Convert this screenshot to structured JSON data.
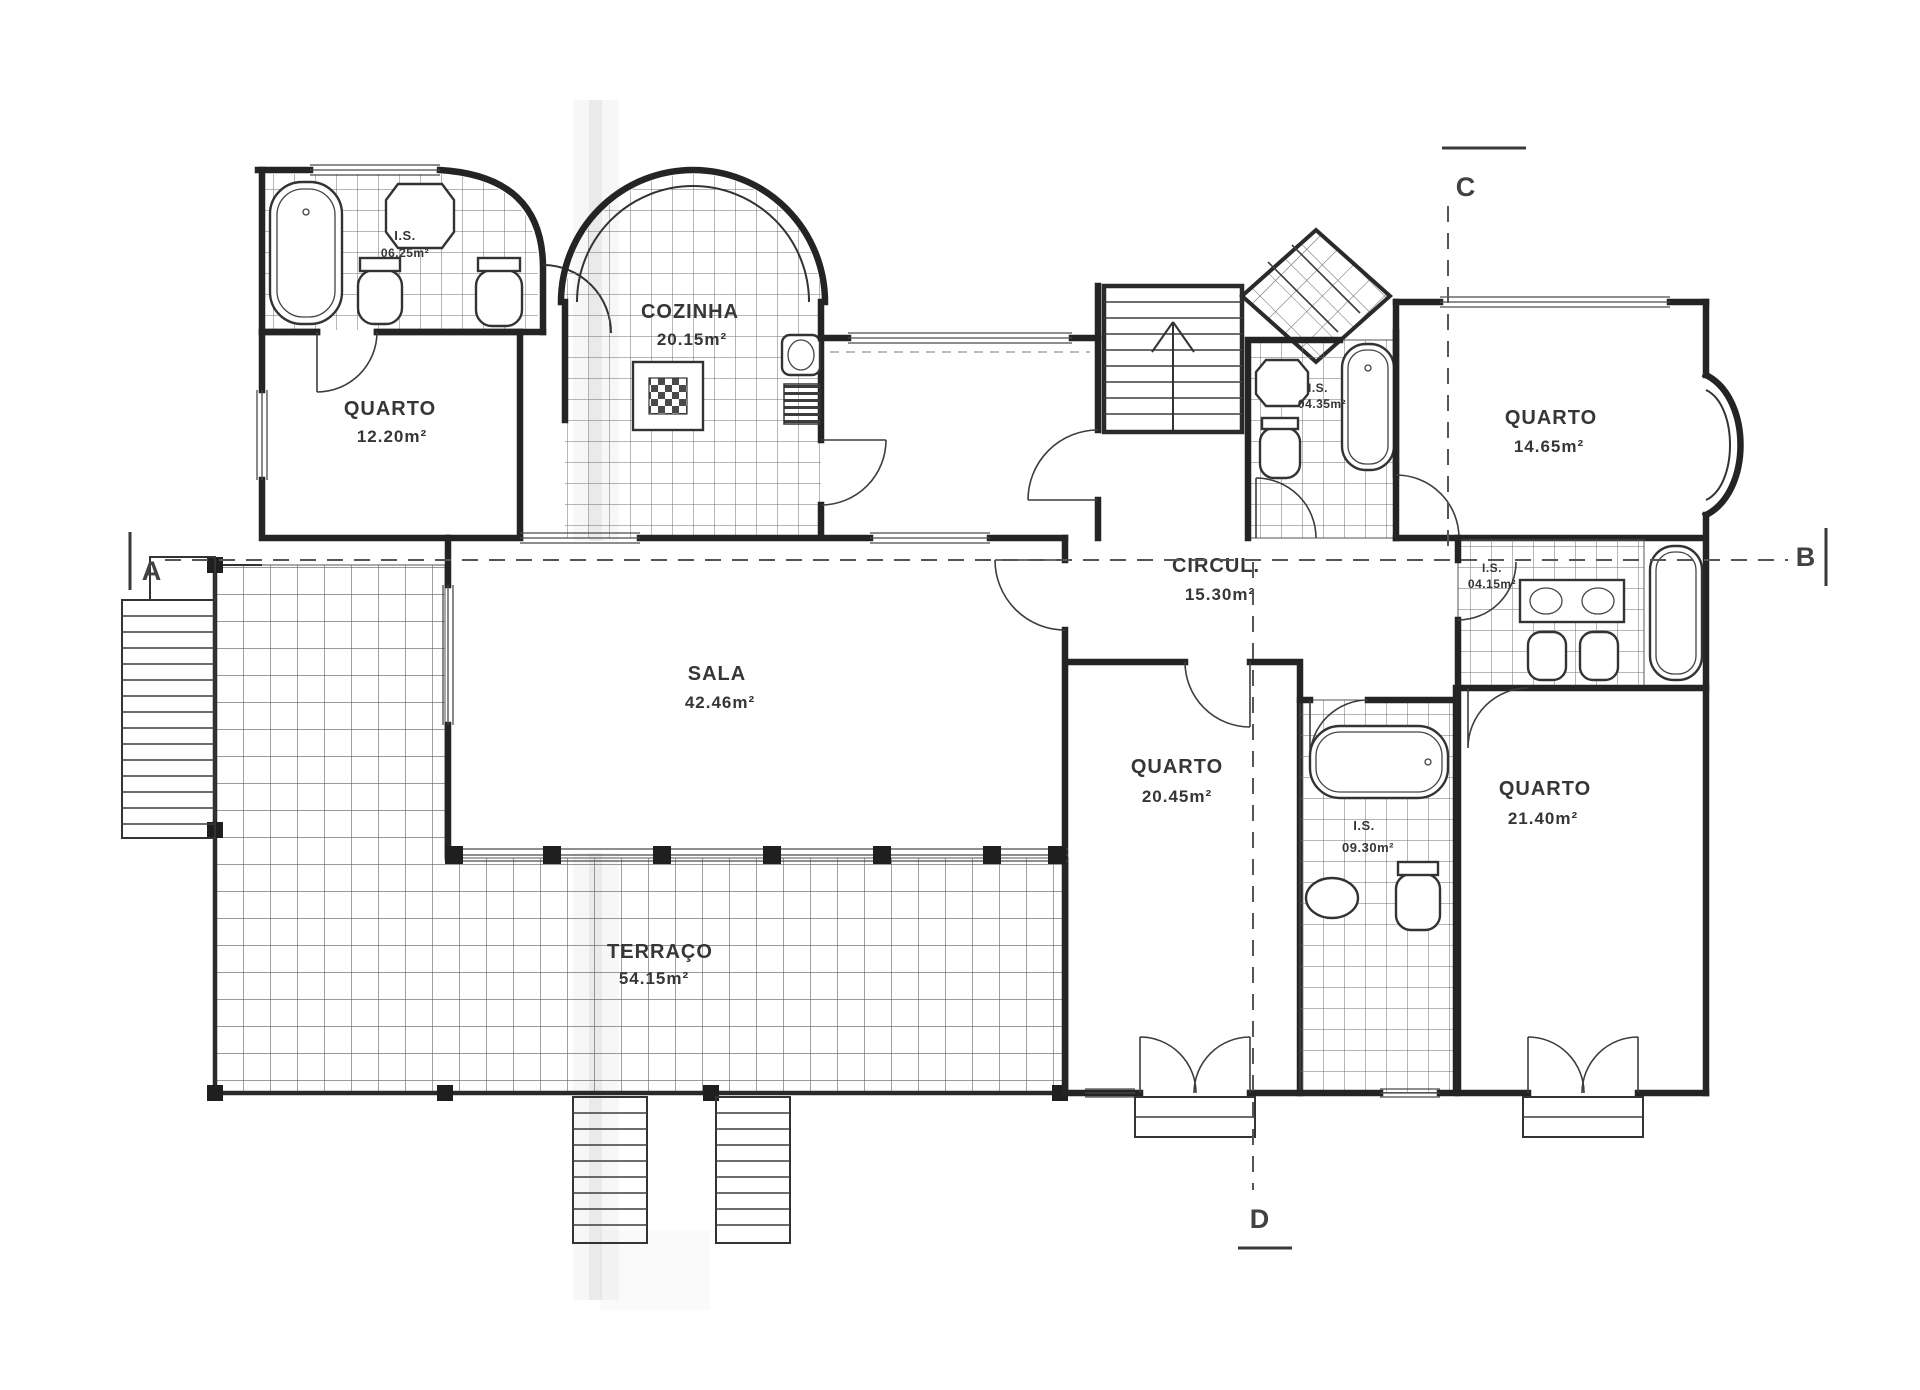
{
  "drawing": {
    "type": "architectural-floor-plan",
    "colors": {
      "ink": "#242424",
      "paper": "#ffffff",
      "tile_line": "#6f6f6f",
      "section_dash": "#555555"
    }
  },
  "rooms": {
    "is_nw": {
      "label": "I.S.",
      "area": "06.25m²"
    },
    "cozinha": {
      "label": "COZINHA",
      "area": "20.15m²"
    },
    "quarto_nw": {
      "label": "QUARTO",
      "area": "12.20m²"
    },
    "quarto_ne": {
      "label": "QUARTO",
      "area": "14.65m²"
    },
    "is_stair": {
      "label": "I.S.",
      "area": "04.35m²"
    },
    "circul": {
      "label": "CIRCUL.",
      "area": "15.30m²"
    },
    "sala": {
      "label": "SALA",
      "area": "42.46m²"
    },
    "quarto_s": {
      "label": "QUARTO",
      "area": "20.45m²"
    },
    "is_s": {
      "label": "I.S.",
      "area": "09.30m²"
    },
    "quarto_se": {
      "label": "QUARTO",
      "area": "21.40m²"
    },
    "terraco": {
      "label": "TERRAÇO",
      "area": "54.15m²"
    },
    "is_e": {
      "label": "I.S.",
      "area": "04.15m²"
    }
  },
  "sections": {
    "a": "A",
    "b": "B",
    "c": "C",
    "d": "D"
  }
}
